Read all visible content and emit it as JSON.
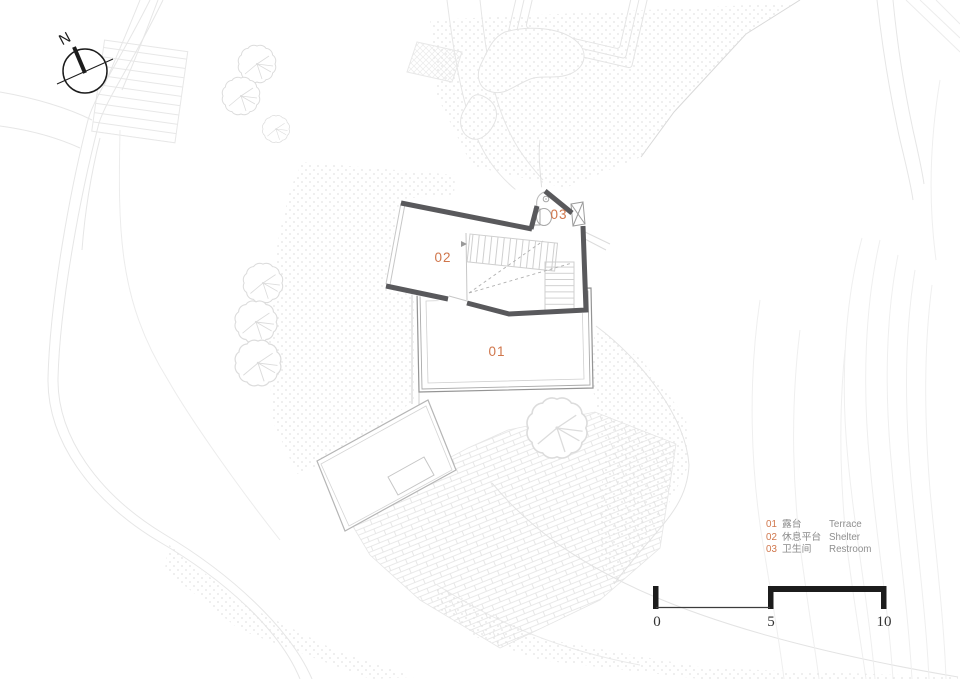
{
  "compass": {
    "label": "N"
  },
  "plan_labels": {
    "terrace_number": "01",
    "shelter_number": "02",
    "restroom_number": "03"
  },
  "legend": {
    "items": [
      {
        "num": "01",
        "zh": "露台",
        "en": "Terrace"
      },
      {
        "num": "02",
        "zh": "休息平台",
        "en": "Shelter"
      },
      {
        "num": "03",
        "zh": "卫生间",
        "en": "Restroom"
      }
    ]
  },
  "scale_bar": {
    "labels": [
      "0",
      "5",
      "10"
    ]
  },
  "colors": {
    "accent_orange": "#d0764b",
    "wall_gray": "#59595c",
    "ink_black": "#1c1c1c",
    "site_line": "#e5e5e5",
    "legend_text": "#8a8a8a"
  }
}
